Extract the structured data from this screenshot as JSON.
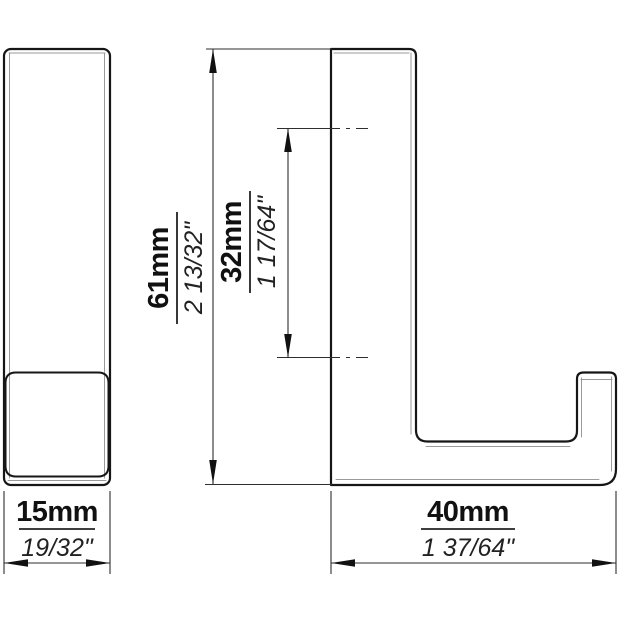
{
  "drawing": {
    "kind": "technical-dimension-drawing",
    "part": "wall-hook",
    "colors": {
      "outline": "#161616",
      "thin_edge": "#9a9a9a",
      "dimension": "#2e2e2e",
      "background": "#ffffff"
    }
  },
  "dimensions": {
    "overall_height": {
      "mm": "61mm",
      "inch": "2 13/32\""
    },
    "hole_spacing": {
      "mm": "32mm",
      "inch": "1 17/64\""
    },
    "overall_width": {
      "mm": "15mm",
      "inch": "19/32\""
    },
    "overall_depth": {
      "mm": "40mm",
      "inch": "1 37/64\""
    }
  }
}
